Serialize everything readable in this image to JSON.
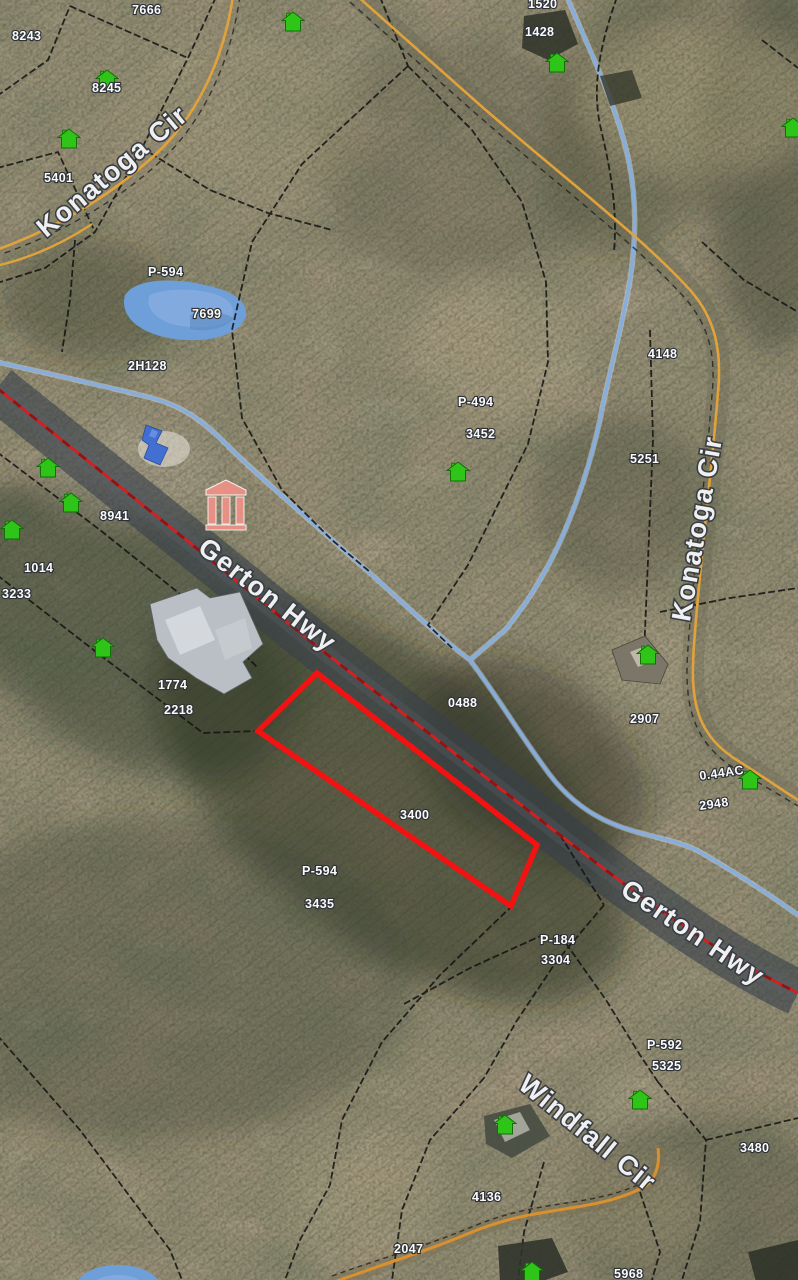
{
  "map": {
    "description": "Aerial GIS parcel map with highlighted lot",
    "colors": {
      "selected_parcel_outline": "#f31212",
      "highway_centerline": "#d61f1f",
      "road_edge_yellow": "#e2a23b",
      "stream_blue": "#85aede",
      "pond_blue": "#6f9fd9",
      "house_marker_green": "#2fc418",
      "boundary_black": "#141414",
      "label_white": "#fafbfc"
    }
  },
  "road_labels": [
    {
      "text": "Konatoga Cir"
    },
    {
      "text": "Gerton Hwy"
    },
    {
      "text": "Konatoga Cir"
    },
    {
      "text": "Gerton Hwy"
    },
    {
      "text": "Windfall Cir"
    }
  ],
  "parcel_labels": [
    {
      "text": "7666"
    },
    {
      "text": "8243"
    },
    {
      "text": "8245"
    },
    {
      "text": "5401"
    },
    {
      "text": "1520"
    },
    {
      "text": "1428"
    },
    {
      "text": "P-594"
    },
    {
      "text": "7699"
    },
    {
      "text": "2H128"
    },
    {
      "text": "4148"
    },
    {
      "text": "P-494"
    },
    {
      "text": "3452"
    },
    {
      "text": "8941"
    },
    {
      "text": "1014"
    },
    {
      "text": "3233"
    },
    {
      "text": "5251"
    },
    {
      "text": "1774"
    },
    {
      "text": "2218"
    },
    {
      "text": "0488"
    },
    {
      "text": "2907"
    },
    {
      "text": "0.44AC"
    },
    {
      "text": "2948"
    },
    {
      "text": "3400"
    },
    {
      "text": "P-594"
    },
    {
      "text": "3435"
    },
    {
      "text": "P-184"
    },
    {
      "text": "3304"
    },
    {
      "text": "P-592"
    },
    {
      "text": "5325"
    },
    {
      "text": "3480"
    },
    {
      "text": "4136"
    },
    {
      "text": "2047"
    },
    {
      "text": "5968"
    }
  ],
  "highlighted_parcel": {
    "label": "3400",
    "outline_color": "#f31212"
  },
  "markers": {
    "house_marker_count": 15,
    "house_marker_color": "#2fc418"
  }
}
